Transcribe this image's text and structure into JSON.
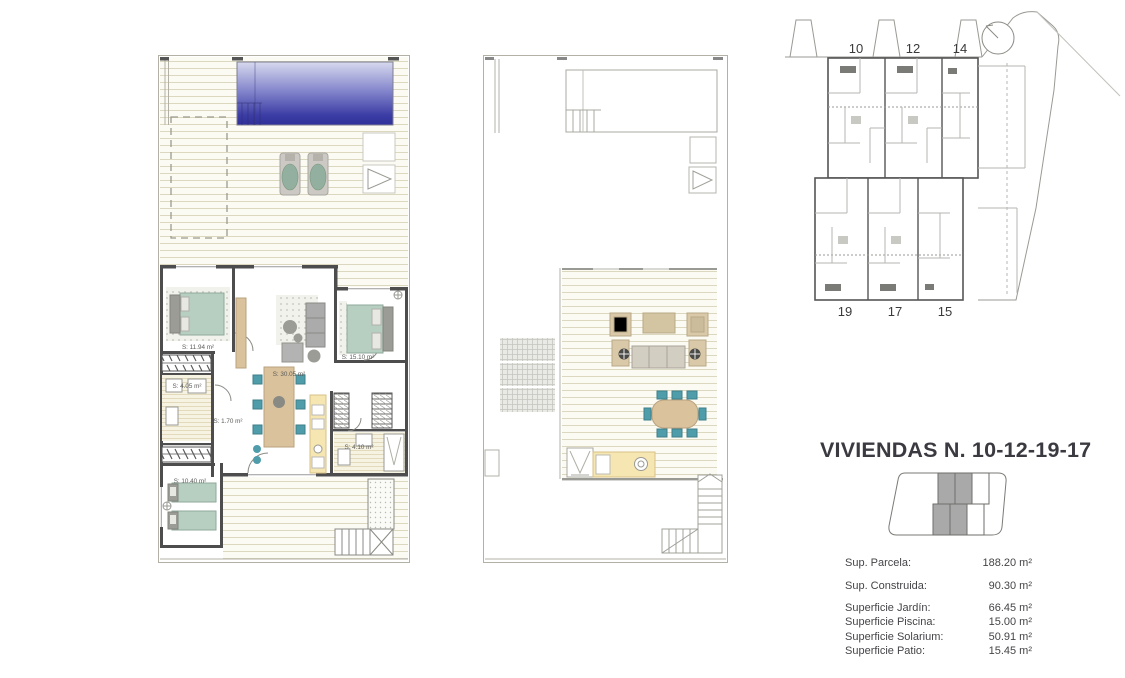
{
  "document": {
    "title": "VIVIENDAS N. 10-12-19-17"
  },
  "ground_floor": {
    "rooms": [
      {
        "name": "bedroom-1",
        "label": "S: 11.94 m²"
      },
      {
        "name": "bathroom-1",
        "label": "S: 4.05 m²"
      },
      {
        "name": "hall",
        "label": "S: 1.70 m²"
      },
      {
        "name": "living-kitchen",
        "label": "S: 30.05 m²"
      },
      {
        "name": "bedroom-2",
        "label": "S: 15.10 m²"
      },
      {
        "name": "bathroom-2",
        "label": "S: 4.10 m²"
      },
      {
        "name": "bedroom-3",
        "label": "S: 10.40 m²"
      }
    ]
  },
  "site_plan": {
    "units_top": [
      "10",
      "12",
      "14"
    ],
    "units_bottom": [
      "19",
      "17",
      "15"
    ]
  },
  "stats": {
    "rows": [
      {
        "label": "Sup. Parcela:",
        "value": "188.20 m²"
      },
      {
        "label": "Sup. Construida:",
        "value": "90.30 m²"
      },
      {
        "label": "Superficie Jardín:",
        "value": "66.45 m²"
      },
      {
        "label": "Superficie Piscina:",
        "value": "15.00 m²"
      },
      {
        "label": "Superficie Solarium:",
        "value": "50.91 m²"
      },
      {
        "label": "Superficie Patio:",
        "value": "15.45 m²"
      }
    ]
  },
  "colors": {
    "pool_top": "#d7d9ee",
    "pool_bottom": "#2f3099",
    "bed_green": "#b7cfc1",
    "furniture_gray": "#ababab",
    "wood_tan": "#d9c29c",
    "counter_yellow": "#f6e6b2",
    "chair_teal": "#4f9dab",
    "wall_dark": "#4d4d4d",
    "deck_line": "#dcd8c0",
    "text_dark": "#3a3a40"
  }
}
